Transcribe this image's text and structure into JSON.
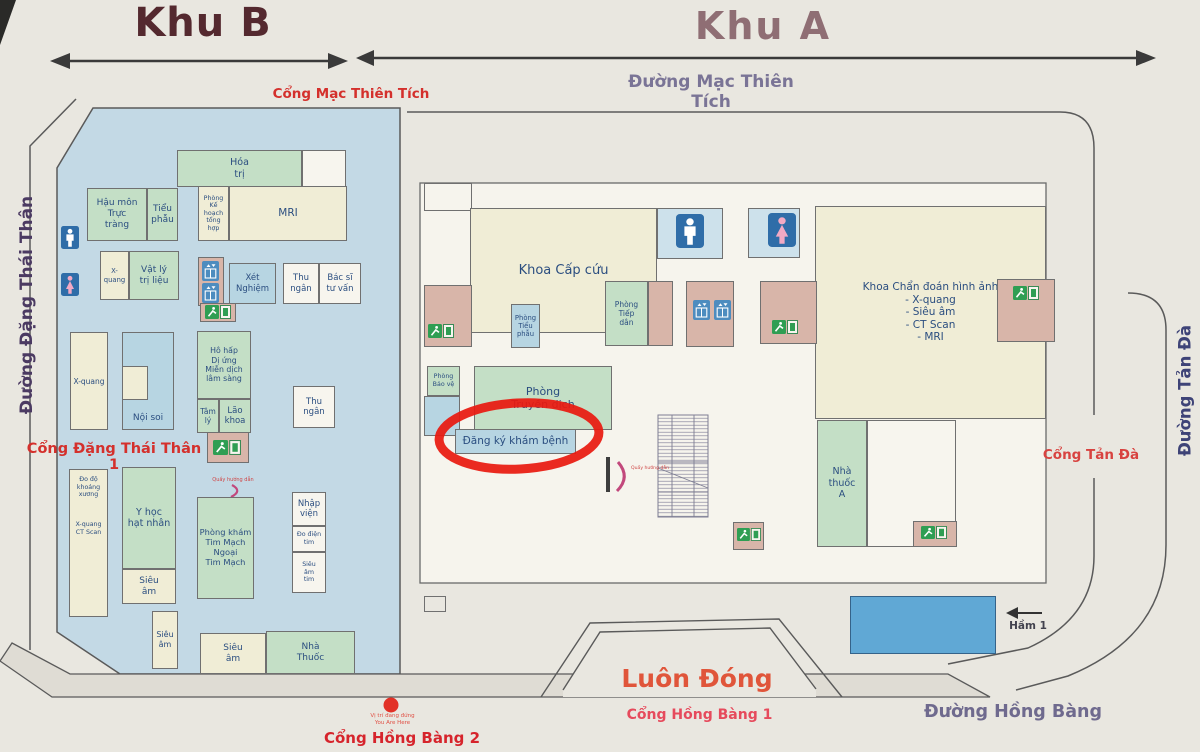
{
  "header": {
    "zone_b_title": "Khu B",
    "zone_a_title": "Khu A",
    "gate_mac_thien_tich": "Cổng Mạc Thiên Tích",
    "street_mac_thien_tich": "Đường Mạc Thiên Tích"
  },
  "streets": {
    "dang_thai_than": "Đường Đặng Thái Thân",
    "tan_da": "Đường Tản Đà",
    "hong_bang": "Đường Hồng Bàng"
  },
  "gates": {
    "dang_thai_than_1": "Cổng Đặng Thái Thân 1",
    "tan_da": "Cổng Tản Đà",
    "hong_bang_1": "Cổng Hồng Bàng 1",
    "hong_bang_2": "Cổng Hồng Bàng 2",
    "always_closed": "Luôn Đóng"
  },
  "markers": {
    "you_are_here_vi": "Vị trí đang đứng",
    "you_are_here_en": "You Are Here",
    "basement_label": "Hầm 1",
    "info_desk": "Quầy hướng dẫn"
  },
  "colors": {
    "zone_b_bg": "#c3d9e5",
    "room_green": "#c4dfc6",
    "room_cream": "#f0edd6",
    "room_blue": "#b7d5e2",
    "room_pink": "#d8b5a9",
    "basement_blue": "#60a8d5",
    "highlight_red": "#e81a10",
    "gate_red": "#d4302c",
    "street_purple": "#6f6a8e"
  },
  "rooms": [
    {
      "id": "hoa-tri",
      "label": "Hóa\ntrị",
      "x": 177,
      "y": 150,
      "w": 125,
      "h": 37,
      "bg": "g",
      "fs": 9.5
    },
    {
      "id": "b-top-blank",
      "label": "",
      "x": 302,
      "y": 150,
      "w": 44,
      "h": 37,
      "bg": "w"
    },
    {
      "id": "hau-mon-truc-trang",
      "label": "Hậu môn\nTrực\ntràng",
      "x": 87,
      "y": 188,
      "w": 60,
      "h": 53,
      "bg": "g",
      "fs": 9
    },
    {
      "id": "tieu-phau-b",
      "label": "Tiểu\nphẫu",
      "x": 147,
      "y": 188,
      "w": 31,
      "h": 53,
      "bg": "g",
      "fs": 9
    },
    {
      "id": "phong-ke-hoach-tong-hop",
      "label": "Phòng\nKế\nhoạch\ntổng\nhợp",
      "x": 198,
      "y": 186,
      "w": 31,
      "h": 55,
      "bg": "c",
      "fs": 6.3
    },
    {
      "id": "mri-b",
      "label": "MRI",
      "x": 229,
      "y": 186,
      "w": 118,
      "h": 55,
      "bg": "c",
      "fs": 10.5
    },
    {
      "id": "x-quang-b1",
      "label": "X-\nquang",
      "x": 100,
      "y": 251,
      "w": 29,
      "h": 49,
      "bg": "c",
      "fs": 6.8
    },
    {
      "id": "vat-ly-tri-lieu",
      "label": "Vật lý\ntrị liệu",
      "x": 129,
      "y": 251,
      "w": 50,
      "h": 49,
      "bg": "g",
      "fs": 9
    },
    {
      "id": "b-elevator-block",
      "label": "",
      "x": 198,
      "y": 257,
      "w": 26,
      "h": 49,
      "bg": "p"
    },
    {
      "id": "xet-nghiem",
      "label": "Xét\nNghiệm",
      "x": 229,
      "y": 263,
      "w": 47,
      "h": 41,
      "bg": "b",
      "fs": 8.5
    },
    {
      "id": "thu-ngan-1",
      "label": "Thu\nngân",
      "x": 283,
      "y": 263,
      "w": 36,
      "h": 41,
      "bg": "w",
      "fs": 8.5
    },
    {
      "id": "bac-si-tu-van",
      "label": "Bác sĩ\ntư vấn",
      "x": 319,
      "y": 263,
      "w": 42,
      "h": 41,
      "bg": "w",
      "fs": 8.5
    },
    {
      "id": "b-exit-block-1",
      "label": "",
      "x": 200,
      "y": 303,
      "w": 36,
      "h": 19,
      "bg": "p"
    },
    {
      "id": "x-quang-b2",
      "label": "X-quang",
      "x": 70,
      "y": 332,
      "w": 38,
      "h": 98,
      "bg": "c",
      "fs": 7.5
    },
    {
      "id": "noi-soi",
      "label": "Nội soi",
      "x": 122,
      "y": 332,
      "w": 52,
      "h": 98,
      "bg": "b",
      "fs": 9,
      "va": "end"
    },
    {
      "id": "noi-soi-inset",
      "label": "",
      "x": 122,
      "y": 366,
      "w": 26,
      "h": 34,
      "bg": "c"
    },
    {
      "id": "ho-hap-di-ung",
      "label": "Hô hấp\nDị ứng\nMiễn dịch\nlâm sàng",
      "x": 197,
      "y": 331,
      "w": 54,
      "h": 68,
      "bg": "g",
      "fs": 7.8
    },
    {
      "id": "tam-ly",
      "label": "Tâm\nlý",
      "x": 197,
      "y": 399,
      "w": 22,
      "h": 34,
      "bg": "g",
      "fs": 7.5
    },
    {
      "id": "lao-khoa",
      "label": "Lão\nkhoa",
      "x": 219,
      "y": 399,
      "w": 32,
      "h": 34,
      "bg": "g",
      "fs": 8.5
    },
    {
      "id": "thu-ngan-2",
      "label": "Thu\nngân",
      "x": 293,
      "y": 386,
      "w": 42,
      "h": 42,
      "bg": "w",
      "fs": 8.5
    },
    {
      "id": "b-exit-block-2",
      "label": "",
      "x": 207,
      "y": 432,
      "w": 42,
      "h": 31,
      "bg": "p"
    },
    {
      "id": "do-do-khoang-xuong",
      "label": "Đo độ\nkhoáng\nxương\n\n\n\nX-quang\nCT Scan",
      "x": 69,
      "y": 469,
      "w": 39,
      "h": 148,
      "bg": "c",
      "fs": 6.3,
      "va": "start"
    },
    {
      "id": "y-hoc-hat-nhan",
      "label": "Y học\nhạt nhân",
      "x": 122,
      "y": 467,
      "w": 54,
      "h": 102,
      "bg": "g",
      "fs": 9.5
    },
    {
      "id": "sieu-am-b1",
      "label": "Siêu\nâm",
      "x": 122,
      "y": 569,
      "w": 54,
      "h": 35,
      "bg": "c",
      "fs": 9
    },
    {
      "id": "phong-kham-tim-mach",
      "label": "Phòng khám\nTim Mạch\nNgoại\nTim Mạch",
      "x": 197,
      "y": 497,
      "w": 57,
      "h": 102,
      "bg": "g",
      "fs": 8.3
    },
    {
      "id": "nhap-vien",
      "label": "Nhập\nviện",
      "x": 292,
      "y": 492,
      "w": 34,
      "h": 34,
      "bg": "w",
      "fs": 8.5
    },
    {
      "id": "do-dien-tim",
      "label": "Đo điện\ntim",
      "x": 292,
      "y": 526,
      "w": 34,
      "h": 26,
      "bg": "w",
      "fs": 6.3
    },
    {
      "id": "sieu-am-tim",
      "label": "Siêu\nâm\ntim",
      "x": 292,
      "y": 552,
      "w": 34,
      "h": 41,
      "bg": "w",
      "fs": 6.3
    },
    {
      "id": "sieu-am-b2",
      "label": "Siêu\nâm",
      "x": 152,
      "y": 611,
      "w": 26,
      "h": 58,
      "bg": "c",
      "fs": 8
    },
    {
      "id": "sieu-am-b3",
      "label": "Siêu\nâm",
      "x": 200,
      "y": 633,
      "w": 66,
      "h": 41,
      "bg": "c",
      "fs": 9
    },
    {
      "id": "nha-thuoc-b",
      "label": "Nhà\nThuốc",
      "x": 266,
      "y": 631,
      "w": 89,
      "h": 43,
      "bg": "g",
      "fs": 9
    },
    {
      "id": "a-wall-block",
      "label": "",
      "x": 424,
      "y": 183,
      "w": 48,
      "h": 28,
      "bg": "t"
    },
    {
      "id": "khoa-cap-cuu",
      "label": "Khoa Cấp cứu",
      "x": 470,
      "y": 208,
      "w": 187,
      "h": 125,
      "bg": "c",
      "fs": 13
    },
    {
      "id": "wc-male-a-block",
      "label": "",
      "x": 657,
      "y": 208,
      "w": 66,
      "h": 51,
      "bg": "wcb"
    },
    {
      "id": "wc-female-a-block",
      "label": "",
      "x": 748,
      "y": 208,
      "w": 52,
      "h": 50,
      "bg": "wcb"
    },
    {
      "id": "khoa-chan-doan-hinh-anh",
      "label": "Khoa Chẩn đoán hình ảnh\n- X-quang\n- Siêu âm\n- CT Scan\n- MRI",
      "x": 815,
      "y": 206,
      "w": 231,
      "h": 213,
      "bg": "c",
      "fs": 10.5
    },
    {
      "id": "a-pink-left",
      "label": "",
      "x": 424,
      "y": 285,
      "w": 48,
      "h": 62,
      "bg": "p"
    },
    {
      "id": "phong-tieu-phau-a",
      "label": "Phòng\nTiểu\nphẫu",
      "x": 511,
      "y": 304,
      "w": 29,
      "h": 44,
      "bg": "b",
      "fs": 6.8
    },
    {
      "id": "phong-tiep-dan",
      "label": "Phòng\nTiếp\ndân",
      "x": 605,
      "y": 281,
      "w": 43,
      "h": 65,
      "bg": "g",
      "fs": 7.5
    },
    {
      "id": "a-tiep-dan-pink",
      "label": "",
      "x": 648,
      "y": 281,
      "w": 25,
      "h": 65,
      "bg": "p"
    },
    {
      "id": "a-elevator-block",
      "label": "",
      "x": 686,
      "y": 281,
      "w": 48,
      "h": 66,
      "bg": "p"
    },
    {
      "id": "a-pink-right-1",
      "label": "",
      "x": 760,
      "y": 281,
      "w": 57,
      "h": 63,
      "bg": "p"
    },
    {
      "id": "a-pink-right-2",
      "label": "",
      "x": 997,
      "y": 279,
      "w": 58,
      "h": 63,
      "bg": "p"
    },
    {
      "id": "phong-bao-ve",
      "label": "Phòng\nBảo vệ",
      "x": 427,
      "y": 366,
      "w": 33,
      "h": 30,
      "bg": "g",
      "fs": 6.3
    },
    {
      "id": "a-blue-block",
      "label": "",
      "x": 424,
      "y": 396,
      "w": 36,
      "h": 40,
      "bg": "b"
    },
    {
      "id": "phong-truyen-dich",
      "label": "Phòng\nTruyền dịch",
      "x": 474,
      "y": 366,
      "w": 138,
      "h": 64,
      "bg": "g",
      "fs": 11
    },
    {
      "id": "dang-ky-kham-benh",
      "label": "Đăng ký khám bệnh",
      "x": 455,
      "y": 429,
      "w": 121,
      "h": 25,
      "bg": "b",
      "fs": 10.5
    },
    {
      "id": "nha-thuoc-a",
      "label": "Nhà\nthuốc\nA",
      "x": 817,
      "y": 420,
      "w": 50,
      "h": 127,
      "bg": "g",
      "fs": 9.5
    },
    {
      "id": "a-white-block",
      "label": "",
      "x": 867,
      "y": 420,
      "w": 89,
      "h": 127,
      "bg": "w"
    },
    {
      "id": "a-pink-pharm",
      "label": "",
      "x": 913,
      "y": 521,
      "w": 44,
      "h": 26,
      "bg": "p"
    },
    {
      "id": "a-pink-mid",
      "label": "",
      "x": 733,
      "y": 522,
      "w": 31,
      "h": 28,
      "bg": "p"
    },
    {
      "id": "a-notch",
      "label": "",
      "x": 424,
      "y": 596,
      "w": 22,
      "h": 16,
      "bg": "t"
    },
    {
      "id": "ham-1",
      "label": "",
      "x": 850,
      "y": 596,
      "w": 146,
      "h": 58,
      "bg": "hb"
    }
  ],
  "icons": [
    {
      "type": "wc-male",
      "x": 61,
      "y": 226,
      "w": 18,
      "h": 23
    },
    {
      "type": "wc-female",
      "x": 61,
      "y": 273,
      "w": 18,
      "h": 23
    },
    {
      "type": "elevator",
      "x": 202,
      "y": 261,
      "w": 17,
      "h": 20
    },
    {
      "type": "elevator",
      "x": 202,
      "y": 283,
      "w": 17,
      "h": 20
    },
    {
      "type": "exit",
      "x": 205,
      "y": 305,
      "w": 26,
      "h": 14
    },
    {
      "type": "exit",
      "x": 213,
      "y": 440,
      "w": 28,
      "h": 15
    },
    {
      "type": "wc-male",
      "x": 676,
      "y": 214,
      "w": 28,
      "h": 34
    },
    {
      "type": "wc-female",
      "x": 768,
      "y": 213,
      "w": 28,
      "h": 34
    },
    {
      "type": "elevator",
      "x": 693,
      "y": 300,
      "w": 17,
      "h": 20
    },
    {
      "type": "elevator",
      "x": 714,
      "y": 300,
      "w": 17,
      "h": 20
    },
    {
      "type": "exit",
      "x": 428,
      "y": 324,
      "w": 26,
      "h": 14
    },
    {
      "type": "exit",
      "x": 772,
      "y": 320,
      "w": 26,
      "h": 14
    },
    {
      "type": "exit",
      "x": 1013,
      "y": 286,
      "w": 26,
      "h": 14
    },
    {
      "type": "exit",
      "x": 737,
      "y": 528,
      "w": 24,
      "h": 13
    },
    {
      "type": "exit",
      "x": 921,
      "y": 526,
      "w": 26,
      "h": 13
    }
  ]
}
